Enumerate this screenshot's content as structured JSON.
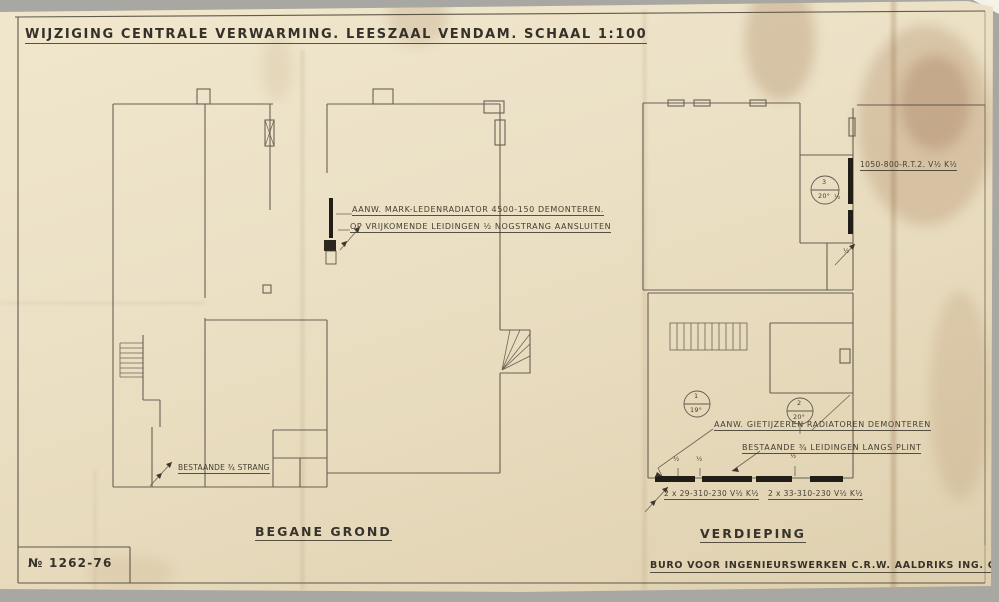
{
  "sheet": {
    "title": "WIJZIGING CENTRALE VERWARMING. LEESZAAL VENDAM. SCHAAL 1:100",
    "drawing_number": "№ 1262-76",
    "footer": "BURO VOOR INGENIEURSWERKEN C.R.W. AALDRIKS ING. GRONINGEN",
    "scale": "1:100"
  },
  "ground_floor": {
    "label": "BEGANE GROND",
    "note_radiator_line1": "AANW. MARK-LEDENRADIATOR 4500-150 DEMONTEREN.",
    "note_radiator_line2": "OP VRIJKOMENDE LEIDINGEN ½ NOGSTRANG AANSLUITEN",
    "note_existing_riser": "BESTAANDE ¾ STRANG"
  },
  "first_floor": {
    "label": "VERDIEPING",
    "note_radiator_spec": "1050-800-R.T.2. V½ K½",
    "note_remove_line1": "AANW. GIETIJZEREN RADIATOREN DEMONTEREN",
    "note_remove_line2": "BESTAANDE ¾ LEIDINGEN LANGS PLINT",
    "spec_left": "2 x 29-310-230 V½ K½",
    "spec_right": "2 x 33-310-230 V½ K½",
    "rooms": [
      {
        "number": "1",
        "temp": "19°"
      },
      {
        "number": "2",
        "temp": "20°"
      },
      {
        "number": "3",
        "temp": "20°"
      }
    ],
    "pipe_labels": [
      "½",
      "½",
      "½",
      "½",
      "½"
    ]
  },
  "colors": {
    "paper": "#ece1c6",
    "ink": "#3b372d",
    "background": "#a9a7a2",
    "stain": "#8a5a30"
  }
}
